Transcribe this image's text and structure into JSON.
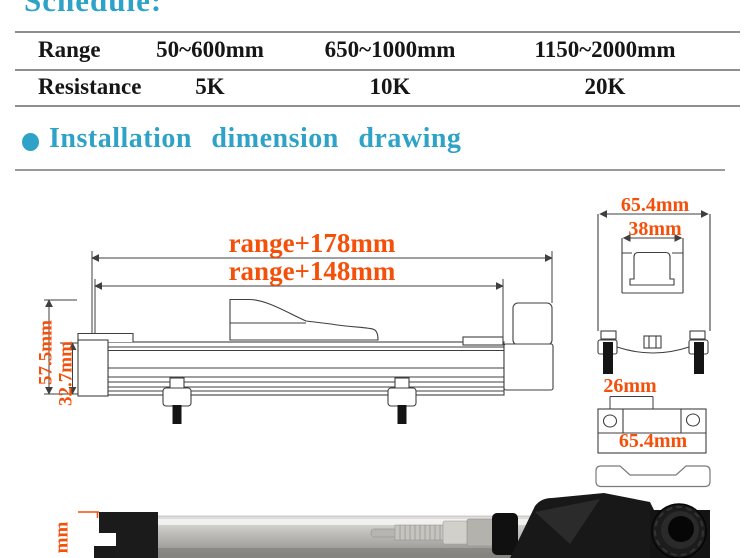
{
  "header": {
    "schedule": "Schedule:"
  },
  "section": {
    "title": "Installation dimension drawing"
  },
  "table": {
    "rows": [
      {
        "label": "Range",
        "values": [
          "50~600mm",
          "650~1000mm",
          "1150~2000mm"
        ]
      },
      {
        "label": "Resistance",
        "values": [
          "5K",
          "10K",
          "20K"
        ]
      }
    ]
  },
  "drawing": {
    "labels": {
      "range_outer": "range+178mm",
      "range_inner": "range+148mm",
      "total_height": "57.5mm",
      "body_height": "32.7mm",
      "end_outer_width": "65.4mm",
      "end_inner_width": "38mm",
      "hole_offset": "26mm",
      "bracket_width": "65.4mm",
      "photo_label_fragment": "mm"
    },
    "colors": {
      "dimension_text": "#f4500a",
      "heading": "#2fa3c7",
      "line": "#3f3f3f",
      "rule": "#8f8f8f"
    }
  }
}
